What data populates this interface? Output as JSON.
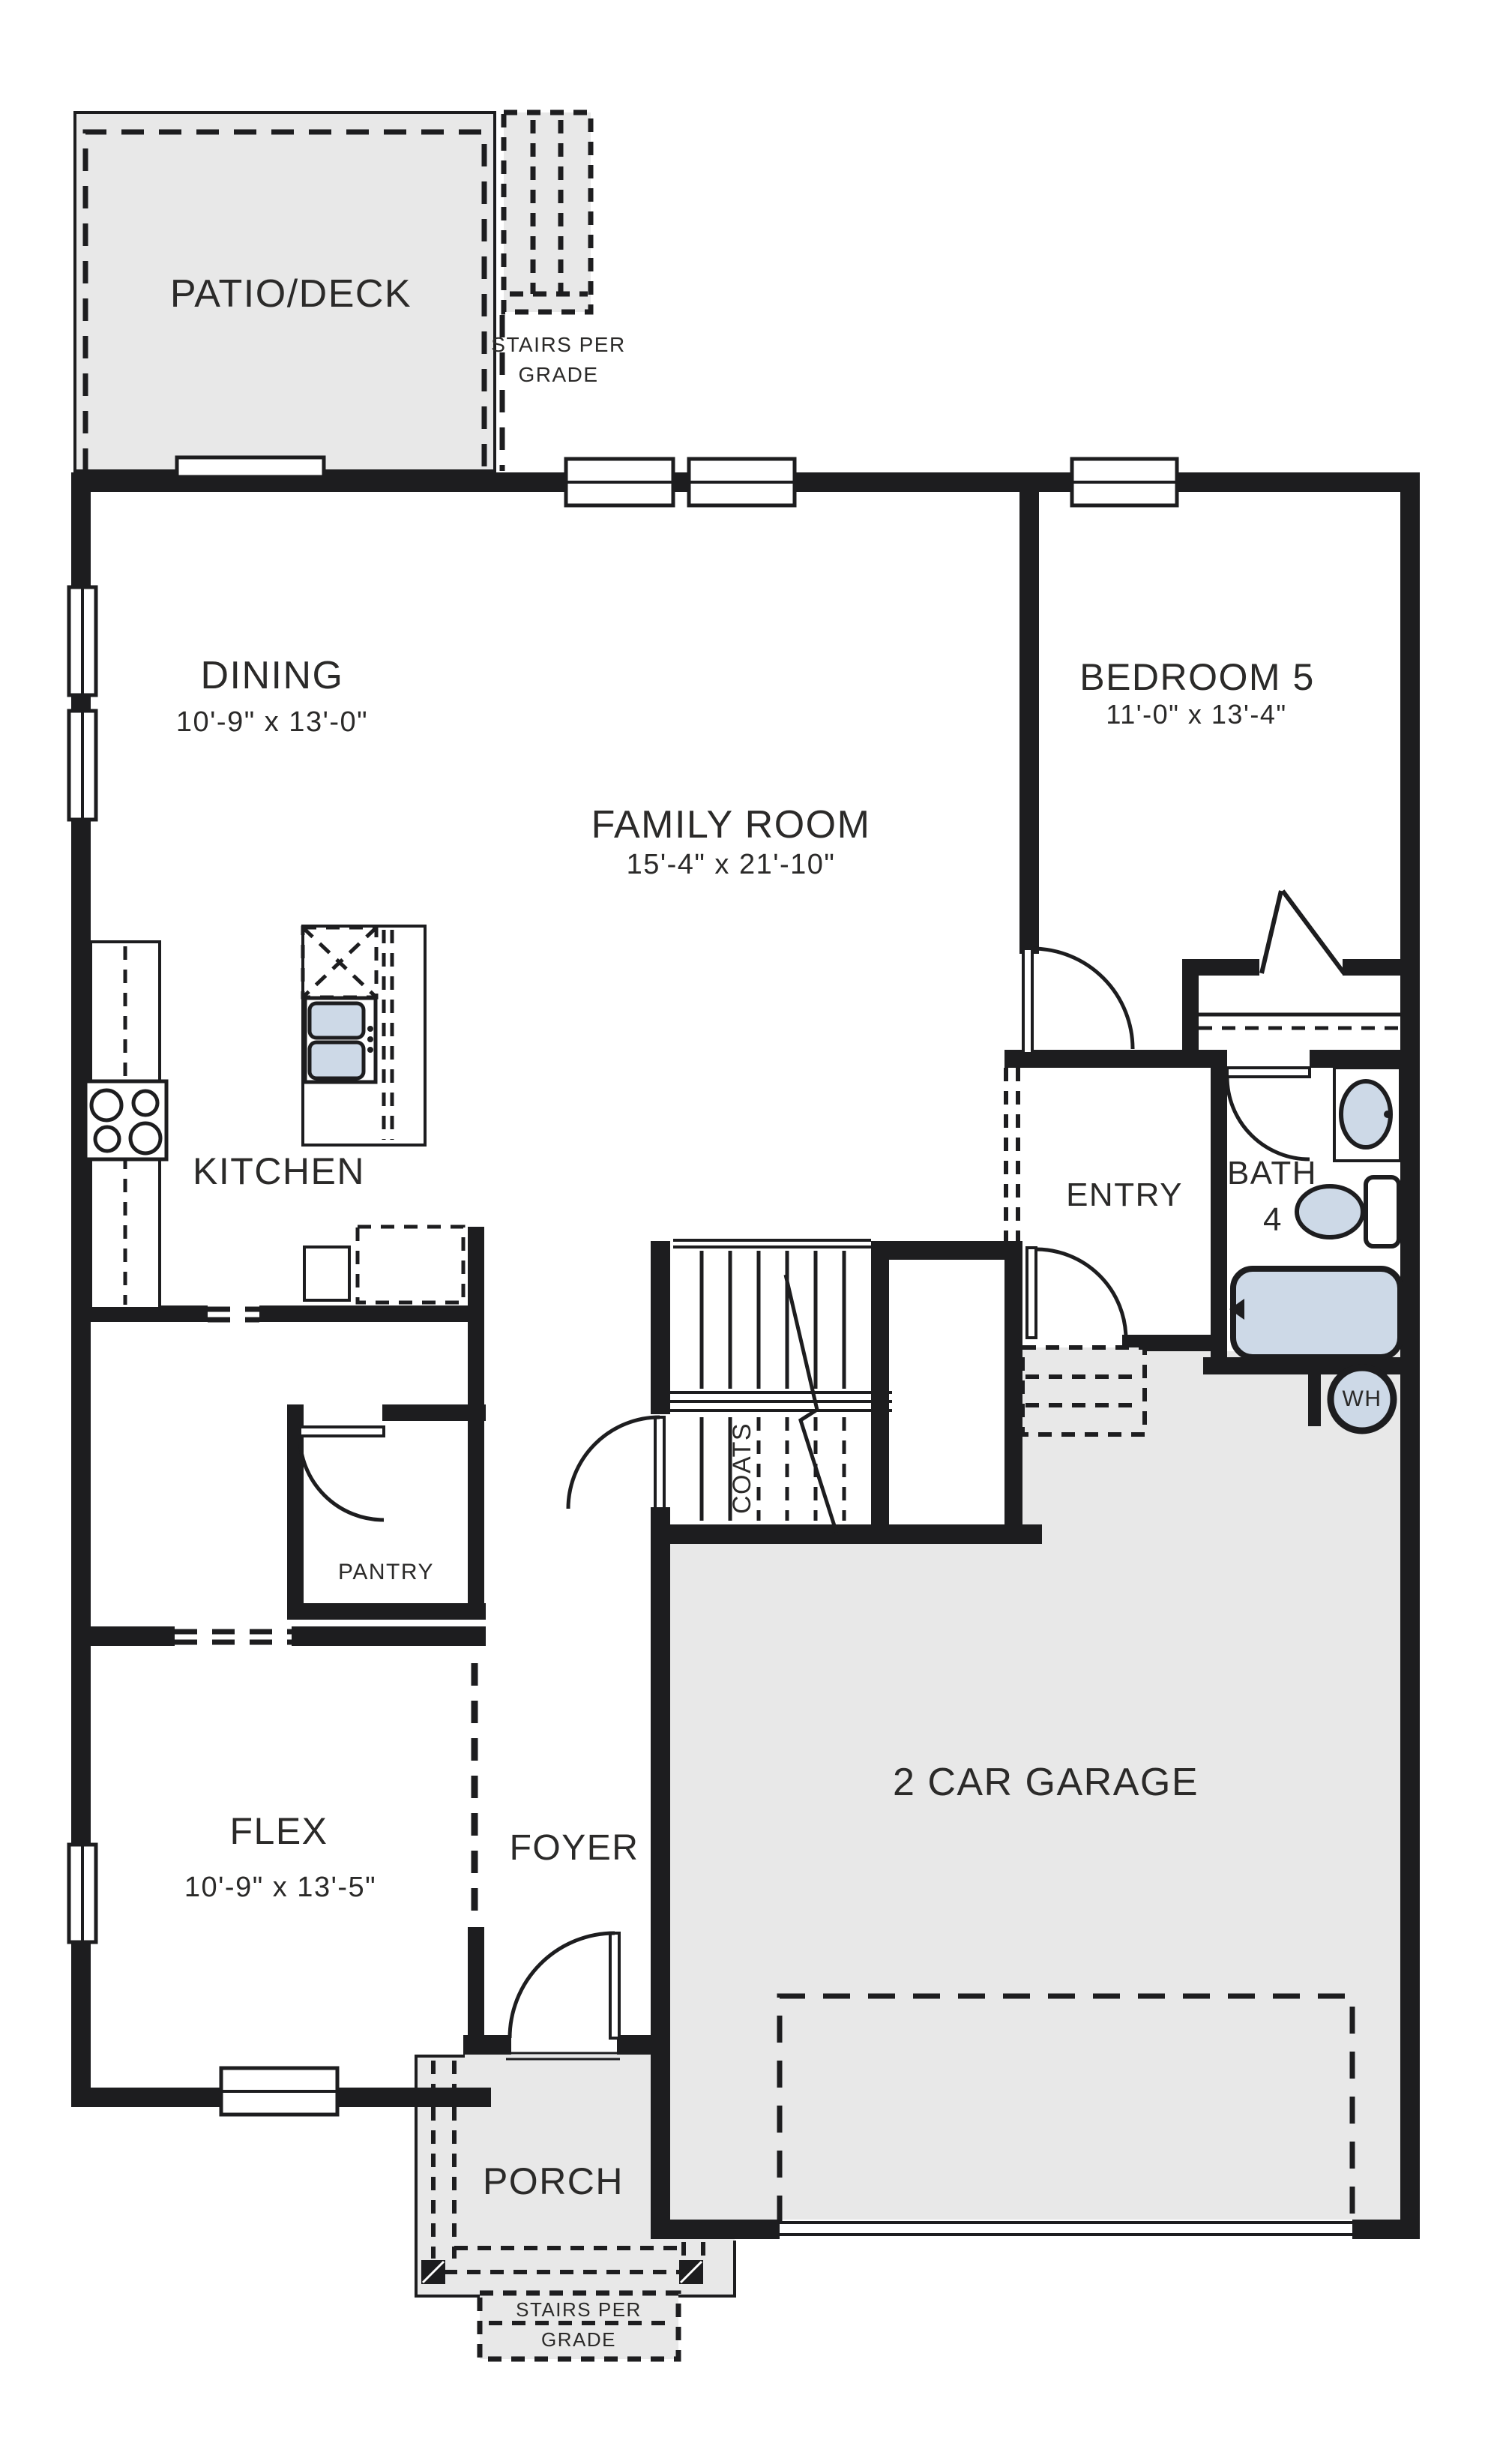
{
  "rooms": {
    "patio_deck": {
      "label": "PATIO/DECK"
    },
    "dining": {
      "label": "DINING",
      "dims": "10'-9\" x 13'-0\""
    },
    "family_room": {
      "label": "FAMILY ROOM",
      "dims": "15'-4\" x 21'-10\""
    },
    "bedroom5": {
      "label": "BEDROOM 5",
      "dims": "11'-0\" x 13'-4\""
    },
    "kitchen": {
      "label": "KITCHEN"
    },
    "entry": {
      "label": "ENTRY"
    },
    "bath4": {
      "label": "BATH",
      "number": "4"
    },
    "pantry": {
      "label": "PANTRY"
    },
    "coats": {
      "label": "COATS"
    },
    "flex": {
      "label": "FLEX",
      "dims": "10'-9\" x 13'-5\""
    },
    "foyer": {
      "label": "FOYER"
    },
    "garage": {
      "label": "2 CAR GARAGE"
    },
    "porch": {
      "label": "PORCH"
    }
  },
  "annotations": {
    "stairs_top": {
      "line1": "STAIRS PER",
      "line2": "GRADE"
    },
    "stairs_bottom": {
      "line1": "STAIRS PER",
      "line2": "GRADE"
    },
    "water_heater": {
      "label": "WH"
    }
  },
  "colors": {
    "wall": "#1d1d1f",
    "area_fill": "#e8e8e8",
    "fixture_fill": "#cdd9e7",
    "text": "#2b2a29",
    "background": "#ffffff"
  }
}
